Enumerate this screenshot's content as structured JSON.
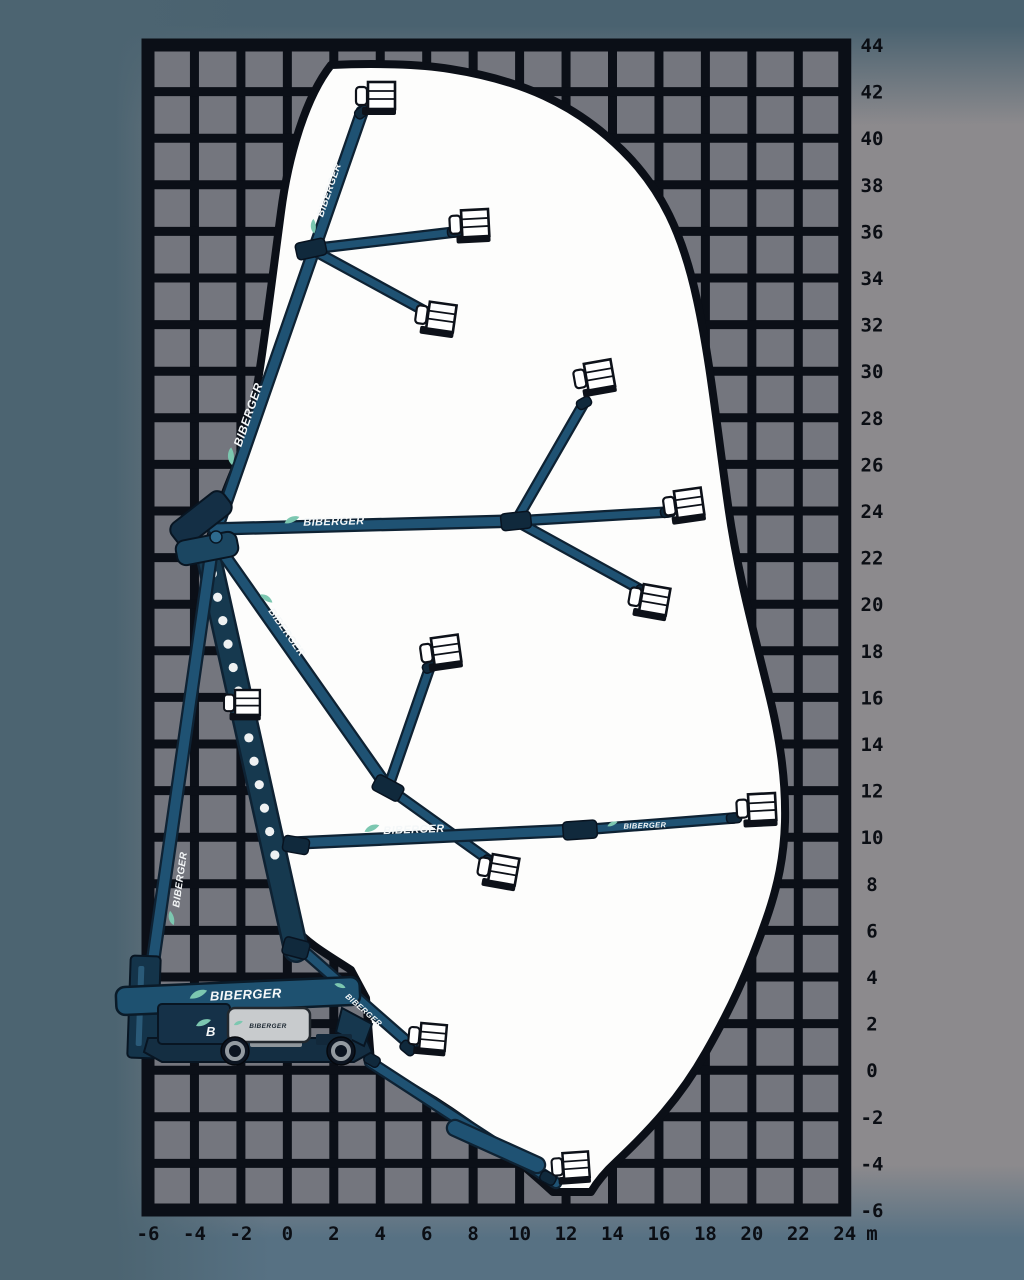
{
  "brand": "BIBERGER",
  "turret_logo": "B",
  "axes": {
    "unit": "m",
    "x_labels": [
      "-6",
      "-4",
      "-2",
      "0",
      "2",
      "4",
      "6",
      "8",
      "10",
      "12",
      "14",
      "16",
      "18",
      "20",
      "22",
      "24"
    ],
    "y_labels": [
      "44",
      "42",
      "40",
      "38",
      "36",
      "34",
      "32",
      "30",
      "28",
      "26",
      "24",
      "22",
      "20",
      "18",
      "16",
      "14",
      "12",
      "10",
      "8",
      "6",
      "4",
      "2",
      "0",
      "-2",
      "-4",
      "-6"
    ]
  },
  "colors": {
    "grid_line": "#0b0f17",
    "grid_cell": "#74767e",
    "envelope_fill": "#fdfdfc",
    "envelope_stroke": "#0b0f17",
    "boom_dark": "#0e2233",
    "boom_mid": "#1f5273",
    "riser_body": "#16394f",
    "hole_fill": "#eef1f2",
    "joint_fill": "#10293c",
    "basket_fill": "#ffffff",
    "basket_stroke": "#0d1119",
    "leaf": "#7cc7b0",
    "text_light": "#f4f7f8",
    "text_dark": "#1b2731"
  },
  "diagram": {
    "grid": {
      "x": 148,
      "y": 45,
      "cols": 15,
      "rows": 25,
      "cw": 46.45,
      "rh": 46.6
    },
    "axis_layout": {
      "bottom_y": 1240,
      "right_x": 872
    },
    "envelope": "M331,65 C372,63 420,64 450,69 C520,80 574,103 622,150 C662,189 683,235 697,300 C710,360 716,420 728,505 C737,570 752,625 768,690 C780,738 786,780 785,822 C784,856 778,886 766,920 C748,972 730,1010 706,1052 C680,1098 650,1130 616,1162 C604,1173 597,1182 591,1192 L553,1192 C518,1160 478,1128 434,1100 L371,1062 L366,998 L351,970 C328,955 308,944 295,928 C277,900 266,845 252,785 C240,730 228,662 218,610 C212,580 206,558 209,542 C217,508 232,477 245,443 C256,412 268,310 281,212 C288,158 305,98 331,65 Z",
    "riser": {
      "x1": 208,
      "y1": 554,
      "x2": 296,
      "y2": 950,
      "w": 21,
      "holes": 13,
      "t0": 0.05,
      "t1": 0.76
    },
    "booms": [
      {
        "x1": 213,
        "y1": 540,
        "x2": 362,
        "y2": 112,
        "w": 9,
        "name": "main-boom-steep"
      },
      {
        "x1": 311,
        "y1": 249,
        "x2": 455,
        "y2": 232,
        "w": 7,
        "name": "jib-upper-horizontal"
      },
      {
        "x1": 311,
        "y1": 249,
        "x2": 432,
        "y2": 315,
        "w": 7,
        "name": "jib-upper-down"
      },
      {
        "x1": 214,
        "y1": 529,
        "x2": 516,
        "y2": 521,
        "w": 9,
        "name": "main-boom-horizontal"
      },
      {
        "x1": 516,
        "y1": 521,
        "x2": 584,
        "y2": 403,
        "w": 7,
        "name": "jib-mid-up"
      },
      {
        "x1": 516,
        "y1": 521,
        "x2": 668,
        "y2": 512,
        "w": 7,
        "name": "jib-mid-straight"
      },
      {
        "x1": 516,
        "y1": 521,
        "x2": 643,
        "y2": 591,
        "w": 7,
        "name": "jib-mid-down"
      },
      {
        "x1": 215,
        "y1": 542,
        "x2": 388,
        "y2": 788,
        "w": 9,
        "name": "main-boom-lowered"
      },
      {
        "x1": 388,
        "y1": 788,
        "x2": 430,
        "y2": 667,
        "w": 7,
        "name": "jib-low-up"
      },
      {
        "x1": 388,
        "y1": 788,
        "x2": 490,
        "y2": 861,
        "w": 7,
        "name": "jib-low-down"
      },
      {
        "x1": 152,
        "y1": 968,
        "x2": 212,
        "y2": 548,
        "w": 10,
        "name": "riser-lift-arm"
      },
      {
        "x1": 296,
        "y1": 843,
        "x2": 580,
        "y2": 830,
        "w": 9,
        "name": "boom-mid-height"
      },
      {
        "x1": 580,
        "y1": 830,
        "x2": 734,
        "y2": 818,
        "w": 7,
        "name": "jib-mid-height"
      },
      {
        "x1": 305,
        "y1": 952,
        "x2": 412,
        "y2": 1046,
        "w": 8,
        "name": "boom-stowed-jib"
      },
      {
        "x1": 370,
        "y1": 1062,
        "x2": 556,
        "y2": 1183,
        "w": 8,
        "name": "boom-below-grade"
      },
      {
        "x1": 455,
        "y1": 1128,
        "x2": 537,
        "y2": 1165,
        "w": 14,
        "name": "boom-below-grade-section"
      }
    ],
    "joints": [
      [
        311,
        249,
        -12,
        30,
        17
      ],
      [
        516,
        521,
        -6,
        30,
        17
      ],
      [
        388,
        788,
        28,
        30,
        17
      ],
      [
        580,
        830,
        -4,
        34,
        18
      ],
      [
        296,
        845,
        10,
        26,
        16
      ],
      [
        296,
        948,
        15,
        26,
        18
      ],
      [
        455,
        232,
        -5,
        15,
        10
      ],
      [
        432,
        315,
        18,
        15,
        10
      ],
      [
        584,
        403,
        -28,
        15,
        10
      ],
      [
        668,
        512,
        -8,
        15,
        10
      ],
      [
        643,
        591,
        22,
        15,
        10
      ],
      [
        430,
        667,
        -22,
        15,
        10
      ],
      [
        490,
        861,
        18,
        15,
        10
      ],
      [
        734,
        818,
        -5,
        15,
        10
      ],
      [
        408,
        1048,
        40,
        16,
        11
      ],
      [
        548,
        1178,
        28,
        16,
        11
      ],
      [
        362,
        112,
        -38,
        15,
        10
      ],
      [
        372,
        1060,
        30,
        16,
        11
      ]
    ],
    "elbow_top": [
      {
        "t": "rect",
        "x": 168,
        "y": 505,
        "w": 66,
        "h": 27,
        "r": 9,
        "rot": -38,
        "f": "#142f45",
        "s": "#081522",
        "sw": 2
      },
      {
        "t": "rect",
        "x": 176,
        "y": 536,
        "w": 62,
        "h": 25,
        "r": 9,
        "rot": -11,
        "f": "#1b4661",
        "s": "#081522",
        "sw": 2
      },
      {
        "t": "circle",
        "cx": 216,
        "cy": 537,
        "r": 6,
        "f": "#2e6a8e",
        "s": "#081522",
        "sw": 1.5
      }
    ],
    "baskets": [
      [
        356,
        82,
        0,
        1
      ],
      [
        449,
        211,
        -3,
        1
      ],
      [
        418,
        300,
        8,
        1
      ],
      [
        572,
        366,
        -10,
        1
      ],
      [
        662,
        493,
        -8,
        1
      ],
      [
        632,
        582,
        10,
        1
      ],
      [
        419,
        640,
        -8,
        1
      ],
      [
        736,
        795,
        -3,
        1
      ],
      [
        481,
        852,
        10,
        1
      ],
      [
        224,
        690,
        0,
        0.92
      ],
      [
        410,
        1022,
        5,
        0.95
      ],
      [
        551,
        1154,
        -4,
        0.95
      ]
    ],
    "brand_texts": [
      {
        "x": 252,
        "y": 416,
        "rot": -71,
        "s": 12,
        "dark": false
      },
      {
        "x": 332,
        "y": 191,
        "rot": -71,
        "s": 10,
        "dark": false
      },
      {
        "x": 334,
        "y": 525,
        "rot": -1.5,
        "s": 11,
        "dark": false
      },
      {
        "x": 284,
        "y": 634,
        "rot": 55,
        "s": 10,
        "dark": false
      },
      {
        "x": 414,
        "y": 833,
        "rot": -2,
        "s": 11,
        "dark": false
      },
      {
        "x": 645,
        "y": 828,
        "rot": -2,
        "s": 7.5,
        "dark": false
      },
      {
        "x": 183,
        "y": 880,
        "rot": -82,
        "s": 10,
        "dark": false
      },
      {
        "x": 246,
        "y": 999,
        "rot": -2.5,
        "s": 13,
        "dark": false
      },
      {
        "x": 362,
        "y": 1012,
        "rot": 41,
        "s": 8,
        "dark": false
      },
      {
        "x": 268,
        "y": 1028,
        "rot": 0,
        "s": 6.5,
        "dark": true
      }
    ],
    "machine_shapes": [
      {
        "t": "line",
        "x1": 150,
        "y1": 1002,
        "x2": 190,
        "y2": 1042,
        "s": "#0e2233",
        "sw": 6
      },
      {
        "t": "line",
        "x1": 163,
        "y1": 997,
        "x2": 203,
        "y2": 1037,
        "s": "#0e2233",
        "sw": 6
      },
      {
        "t": "rect",
        "x": 129,
        "y": 956,
        "w": 30,
        "h": 102,
        "r": 4,
        "rot": 2,
        "f": "#14344a",
        "s": "#081522",
        "sw": 2
      },
      {
        "t": "rect",
        "x": 137,
        "y": 966,
        "w": 6,
        "h": 80,
        "r": 2,
        "rot": 2,
        "f": "#2a5a78"
      },
      {
        "t": "path",
        "d": "M148,1038 L366,1038 L372,1052 L354,1062 L162,1062 L144,1052 Z",
        "f": "#142e42",
        "s": "#081522",
        "sw": 2
      },
      {
        "t": "rect",
        "x": 250,
        "y": 1034,
        "w": 52,
        "h": 13,
        "r": 2,
        "f": "#8f969b"
      },
      {
        "t": "rect",
        "x": 116,
        "y": 982,
        "w": 244,
        "h": 28,
        "r": 9,
        "rot": -2.5,
        "f": "#1e5170",
        "s": "#0a1b29",
        "sw": 2.5
      },
      {
        "t": "rect",
        "x": 158,
        "y": 1004,
        "w": 72,
        "h": 40,
        "r": 4,
        "f": "#153148",
        "s": "#081522",
        "sw": 2
      },
      {
        "t": "rect",
        "x": 228,
        "y": 1008,
        "w": 82,
        "h": 34,
        "r": 7,
        "f": "#c8cbcd",
        "s": "#22282e",
        "sw": 2.5
      },
      {
        "t": "path",
        "d": "M342,1008 L372,1024 L364,1046 L336,1032 Z",
        "f": "#16374e",
        "s": "#081522",
        "sw": 2
      },
      {
        "t": "rect",
        "x": 316,
        "y": 1034,
        "w": 36,
        "h": 11,
        "r": 2,
        "f": "#12283a"
      },
      {
        "t": "circle",
        "cx": 235,
        "cy": 1051,
        "r": 14,
        "f": "#0c1420",
        "s": "#05080d",
        "sw": 1.5,
        "name": "rear-wheel"
      },
      {
        "t": "circle",
        "cx": 235,
        "cy": 1051,
        "r": 8,
        "f": "none",
        "s": "#949ba1",
        "sw": 4
      },
      {
        "t": "circle",
        "cx": 235,
        "cy": 1051,
        "r": 2.6,
        "f": "#0c1420"
      },
      {
        "t": "circle",
        "cx": 341,
        "cy": 1051,
        "r": 14,
        "f": "#0c1420",
        "s": "#05080d",
        "sw": 1.5,
        "name": "front-wheel"
      },
      {
        "t": "circle",
        "cx": 341,
        "cy": 1051,
        "r": 8,
        "f": "none",
        "s": "#949ba1",
        "sw": 4
      },
      {
        "t": "circle",
        "cx": 341,
        "cy": 1051,
        "r": 2.6,
        "f": "#0c1420"
      },
      {
        "t": "path",
        "d": "M196,1026 C199,1019 207,1018 211,1020 C207,1025 201,1027 196,1026",
        "f": "#7cc7b0"
      }
    ]
  }
}
